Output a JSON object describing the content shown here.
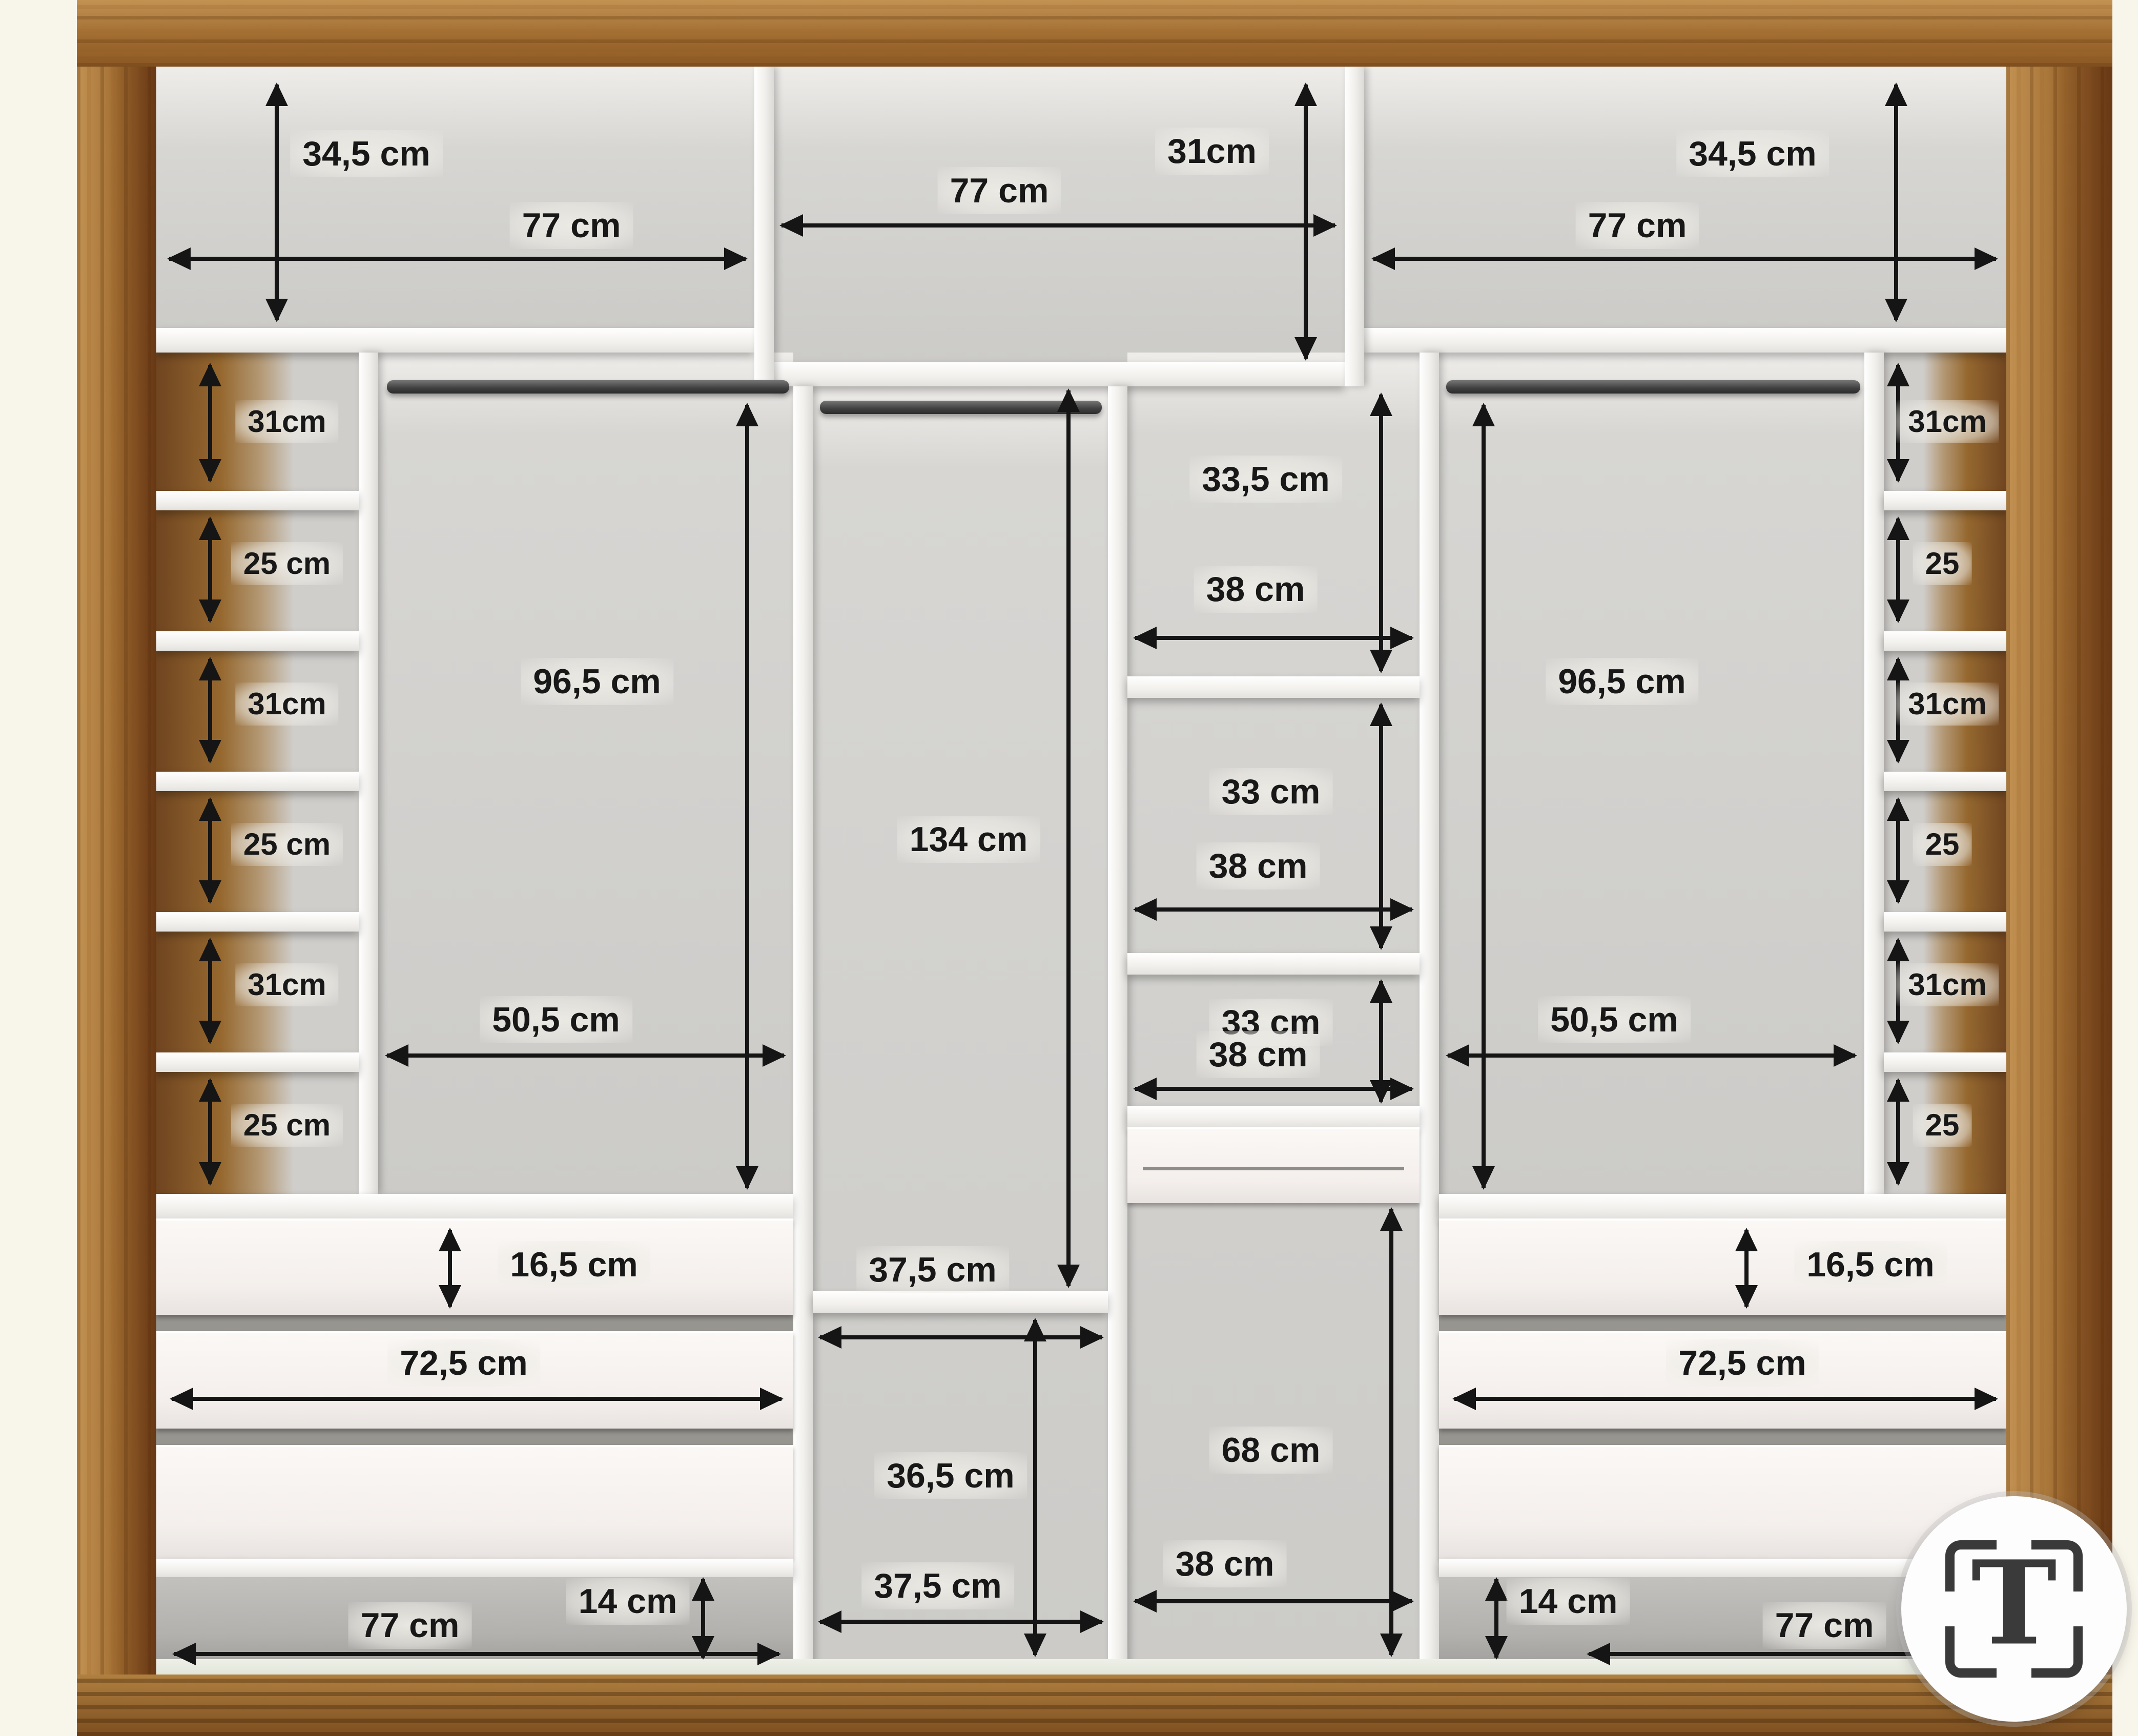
{
  "diagram": {
    "type": "wardrobe-interior-dimensions",
    "unit": "cm",
    "accent_wood_color": "#a97a3e",
    "panel_color": "#f4f2ee",
    "interior_color": "#d2d1ce",
    "dimension_color": "#151515"
  },
  "dims": {
    "t_l_h": "34,5 cm",
    "t_l_w": "77 cm",
    "t_c_w": "77 cm",
    "t_c_h": "31cm",
    "t_r_h": "34,5 cm",
    "t_r_w": "77 cm",
    "lcol": [
      "31cm",
      "25 cm",
      "31cm",
      "25 cm",
      "31cm",
      "25 cm"
    ],
    "rcol": [
      "31cm",
      "25",
      "31cm",
      "25",
      "31cm",
      "25"
    ],
    "lh_h": "96,5 cm",
    "lh_w": "50,5 cm",
    "rh_h": "96,5 cm",
    "rh_w": "50,5 cm",
    "c_h": "134 cm",
    "c_w": "37,5 cm",
    "cb_h": "36,5 cm",
    "cb_w": "37,5 cm",
    "s1_h": "33,5 cm",
    "s1_w": "38 cm",
    "s2_h": "33 cm",
    "s2_w": "38 cm",
    "s3_h": "33 cm",
    "s3_w": "38 cm",
    "sb_h": "68 cm",
    "sb_w": "38 cm",
    "ld_h": "16,5 cm",
    "ld_w": "72,5 cm",
    "rd_h": "16,5 cm",
    "rd_w": "72,5 cm",
    "lp_h": "14 cm",
    "lp_w": "77 cm",
    "rp_h": "14 cm",
    "rp_w": "77 cm"
  },
  "badge": {
    "letter": "T"
  }
}
